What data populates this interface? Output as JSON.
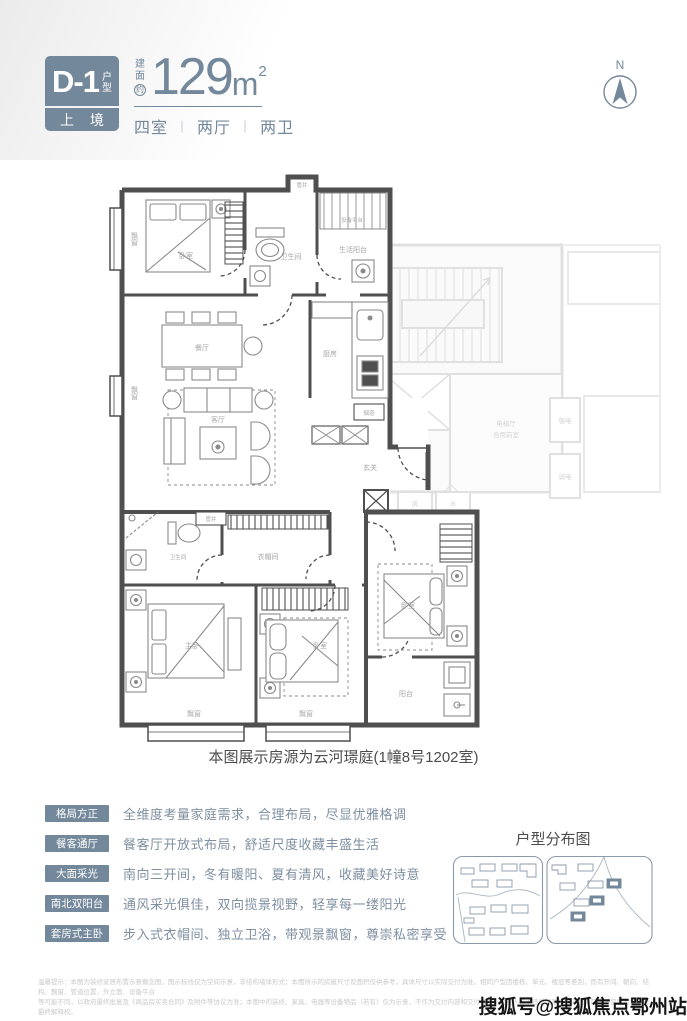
{
  "colors": {
    "accent": "#74889B",
    "wall": "#4F4F4F",
    "ghost": "#DFDFDF",
    "feature_desc": "#7E8FA0",
    "caption": "#4C4C4C"
  },
  "header": {
    "unit_code": "D-1",
    "unit_suffix_chars": [
      "户",
      "型"
    ],
    "series": "上 境",
    "area_prefix_chars": [
      "建",
      "面",
      "约"
    ],
    "area_value": "129",
    "area_unit": "m",
    "area_exp": "2",
    "layout_rooms": "四室",
    "layout_sep": "｜",
    "layout_halls": "两厅",
    "layout_baths": "两卫"
  },
  "compass": {
    "north": "N"
  },
  "plan": {
    "rooms": {
      "bay_tl": "飘窗",
      "bed_tl": "卧室",
      "shaft_top": "管井",
      "bath_top": "卫生间",
      "service_balcony": "生活阳台",
      "equip_platform": "设备平台",
      "dining": "餐厅",
      "kitchen": "厨房",
      "flue": "烟道",
      "living": "客厅",
      "bay_ml": "飘窗",
      "foyer": "玄关",
      "shaft_mid": "管井",
      "bath_low": "卫生间",
      "cloak": "衣帽间",
      "master": "主卧",
      "bed_mid": "卧室",
      "bed_right": "卧室",
      "balcony": "阳台",
      "bay_b1": "飘窗",
      "bay_b2": "飘窗"
    },
    "ghost": {
      "hall1": "电梯厅",
      "hall2": "合用前室",
      "strong": "强电",
      "weak": "弱电",
      "wind": "风",
      "water": "水"
    }
  },
  "caption": "本图展示房源为云河璟庭(1幢8号1202室)",
  "features": [
    {
      "tag": "格局方正",
      "desc": "全维度考量家庭需求，合理布局，尽显优雅格调"
    },
    {
      "tag": "餐客通厅",
      "desc": "餐客厅开放式布局，舒适尺度收藏丰盛生活"
    },
    {
      "tag": "大面采光",
      "desc": "南向三开间，冬有暖阳、夏有清风，收藏美好诗意"
    },
    {
      "tag": "南北双阳台",
      "desc": "通风采光俱佳，双向揽景视野，轻享每一缕阳光"
    },
    {
      "tag": "套房式主卧",
      "desc": "步入式衣帽间、独立卫浴，带观景飘窗，尊崇私密享受"
    }
  ],
  "distribution": {
    "title": "户型分布图"
  },
  "disclaimer": {
    "line1": "温馨提示：本图为装修家居布置示意概念图，图示标线仅为空间示意，非结构墙体形式；本图所示的房屋尺寸及面积仅供参考，具体尺寸以实际交付为准。相同户型因楼栋、单元、楼层等差别，而有开间、朝向、结构、飘窗、管道位置、外立面、设备平台",
    "line2": "等可能不同，以政府最终批复及《商品房买卖合同》及附件等协议为准；本图中的装修、家具、电器等设备物品（若有）仅为示意，不作为交付内容和交付标准。出卖人在不违反国家法律法规的前提下保留对本图的最终解释权。"
  },
  "watermark": "搜狐号@搜狐焦点鄂州站"
}
